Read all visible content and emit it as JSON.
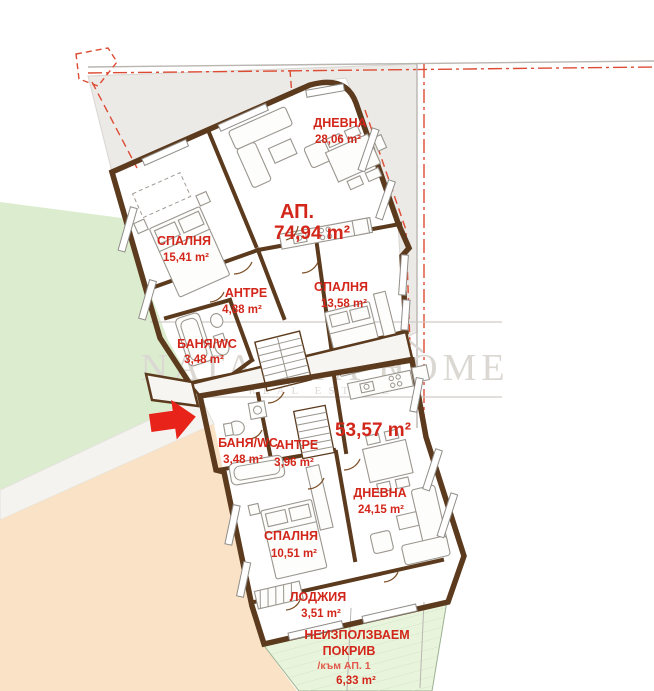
{
  "plan": {
    "watermark": {
      "brand": "NATALIYA HOME",
      "tagline": "REAL ESTATE"
    },
    "apartment_main": {
      "label": "АП.",
      "area": "74,94 m²",
      "rooms": [
        {
          "name": "ДНЕВНА",
          "area": "28,06 m²"
        },
        {
          "name": "СПАЛНЯ",
          "area": "15,41 m²"
        },
        {
          "name": "СПАЛНЯ",
          "area": "13,58 m²"
        },
        {
          "name": "АНТРЕ",
          "area": "4,88 m²"
        },
        {
          "name": "БАНЯ/WC",
          "area": "3,48 m²"
        }
      ]
    },
    "apartment_second": {
      "area": "53,57 m²",
      "rooms": [
        {
          "name": "БАНЯ/WC",
          "area": "3,48 m²"
        },
        {
          "name": "АНТРЕ",
          "area": "3,96 m²"
        },
        {
          "name": "ДНЕВНА",
          "area": "24,15 m²"
        },
        {
          "name": "СПАЛНЯ",
          "area": "10,51 m²"
        },
        {
          "name": "ЛОДЖИЯ",
          "area": "3,51 m²"
        }
      ]
    },
    "roof_note": {
      "line1": "НЕИЗПОЛЗВАЕМ",
      "line2": "ПОКРИВ",
      "line3": "/към АП. 1",
      "area": "6,33 m²"
    },
    "colors": {
      "apartment_main_fill": "#f8d7b3",
      "apartment_second_fill": "#d9efbf",
      "lawn": "#dcedcf",
      "label_red": "#d3261a",
      "wall_brown": "#5b3a1d",
      "arrow_red": "#e8231a"
    }
  }
}
